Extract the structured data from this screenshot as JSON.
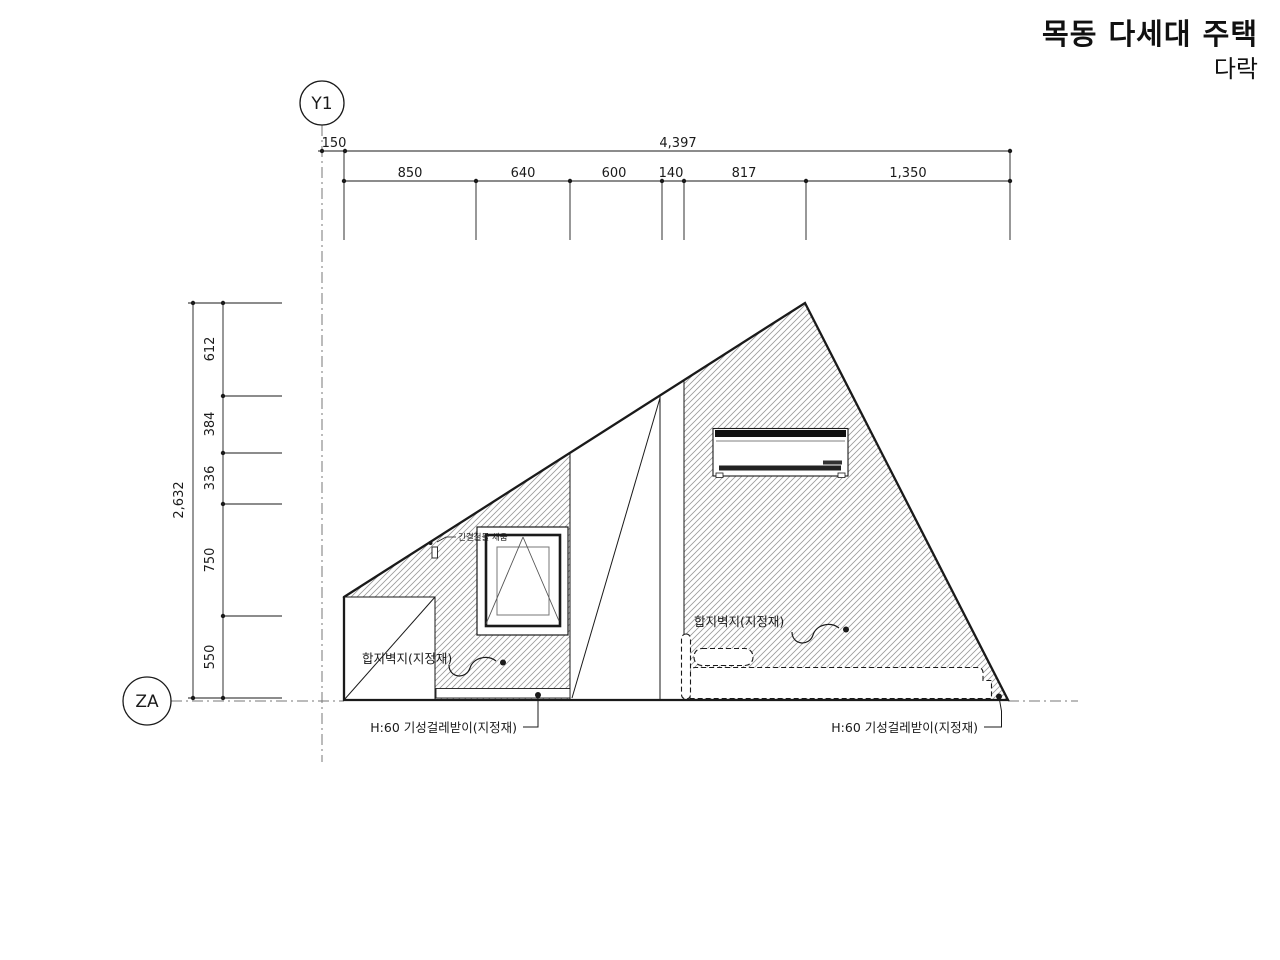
{
  "title": {
    "project": "목동 다세대 주택",
    "sheet": "다락"
  },
  "grid": {
    "horizontal_marker": "Y1",
    "vertical_marker": "ZA"
  },
  "dimensions": {
    "top": {
      "offset": "150",
      "overall": "4,397",
      "segments": [
        "850",
        "640",
        "600",
        "140",
        "817",
        "1,350"
      ]
    },
    "left": {
      "overall": "2,632",
      "segments": [
        "612",
        "384",
        "336",
        "750",
        "550"
      ]
    }
  },
  "labels": {
    "wall_finish_left": "합지벽지(지정재)",
    "wall_finish_right": "합지벽지(지정재)",
    "baseboard_left": "H:60 기성걸레받이(지정재)",
    "baseboard_right": "H:60 기성걸레받이(지정재)",
    "window_joint_note": "긴결철물 채움"
  },
  "colors": {
    "line": "#1a1a1a",
    "hatch": "#9a9a9a",
    "background": "#ffffff"
  }
}
